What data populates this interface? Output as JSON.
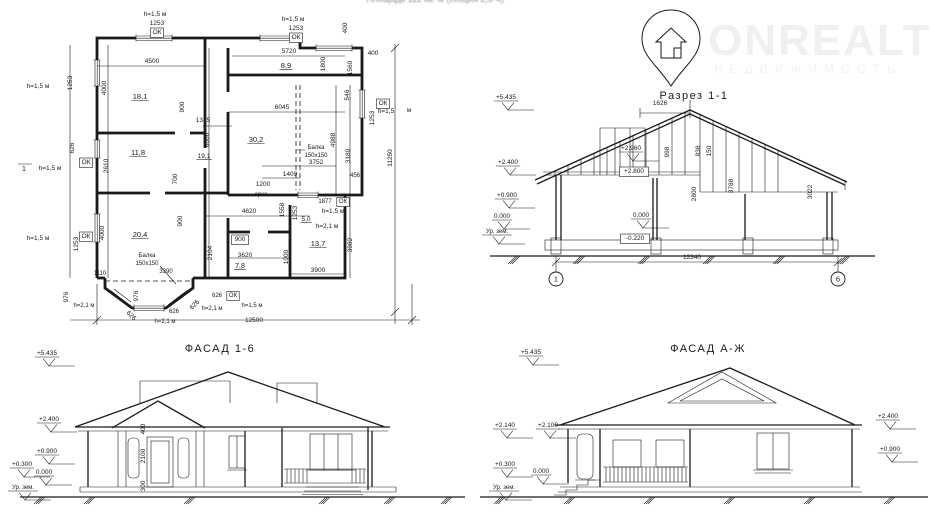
{
  "page": {
    "top_caption": "Площадь 111 кв. м (секция 2,3-4)"
  },
  "watermark": {
    "brand": "ONREALT",
    "subtitle": "НЕДВИЖИМОСТЬ",
    "icon": "location-pin-house-icon",
    "color": "#f1f1f1"
  },
  "drawings": {
    "floor_plan": {
      "name": "floor-plan",
      "labels": [
        {
          "t": "h=1,5 м",
          "x": 155,
          "y": 16
        },
        {
          "t": "1253",
          "x": 157,
          "y": 25
        },
        {
          "t": "ОК",
          "x": 157,
          "y": 34,
          "b": 1
        },
        {
          "t": "h=1,5 м",
          "x": 293,
          "y": 21
        },
        {
          "t": "1253",
          "x": 296,
          "y": 30
        },
        {
          "t": "ОК",
          "x": 296,
          "y": 39,
          "b": 1
        },
        {
          "t": "400",
          "x": 347,
          "y": 28,
          "r": -90
        },
        {
          "t": "4500",
          "x": 152,
          "y": 63
        },
        {
          "t": "4000",
          "x": 106,
          "y": 88,
          "r": -90
        },
        {
          "t": "18,1",
          "x": 140,
          "y": 99,
          "u": 1,
          "s": 7.5
        },
        {
          "t": "900",
          "x": 184,
          "y": 107,
          "r": -90
        },
        {
          "t": "1315",
          "x": 203,
          "y": 122
        },
        {
          "t": "8666",
          "x": 209,
          "y": 140,
          "r": -90
        },
        {
          "t": "19,1",
          "x": 204,
          "y": 158,
          "u": 1
        },
        {
          "t": "11,8",
          "x": 138,
          "y": 155,
          "u": 1,
          "s": 7.5
        },
        {
          "t": "2610",
          "x": 108,
          "y": 166,
          "r": -90
        },
        {
          "t": "1253",
          "x": 72,
          "y": 83,
          "r": -90
        },
        {
          "t": "h=1,5 м",
          "x": 38,
          "y": 88
        },
        {
          "t": "626",
          "x": 74,
          "y": 148,
          "r": -90
        },
        {
          "t": "ОК",
          "x": 86,
          "y": 164,
          "b": 1
        },
        {
          "t": "1",
          "x": 24,
          "y": 171,
          "s": 7
        },
        {
          "t": "h=1,5 м",
          "x": 50,
          "y": 170
        },
        {
          "t": "1253",
          "x": 78,
          "y": 244,
          "r": -90
        },
        {
          "t": "ОК",
          "x": 86,
          "y": 238,
          "b": 1
        },
        {
          "t": "h=1,5 м",
          "x": 38,
          "y": 240
        },
        {
          "t": "5720",
          "x": 289,
          "y": 53
        },
        {
          "t": "8,9",
          "x": 286,
          "y": 68,
          "u": 1,
          "s": 7.5
        },
        {
          "t": "1800",
          "x": 325,
          "y": 64,
          "r": -90
        },
        {
          "t": "1560",
          "x": 352,
          "y": 68,
          "r": -90
        },
        {
          "t": "400",
          "x": 373,
          "y": 55
        },
        {
          "t": "546",
          "x": 349,
          "y": 95,
          "r": -90
        },
        {
          "t": "ОК",
          "x": 383,
          "y": 105,
          "b": 1
        },
        {
          "t": "h=1,5",
          "x": 386,
          "y": 113
        },
        {
          "t": "м",
          "x": 409,
          "y": 112
        },
        {
          "t": "1253",
          "x": 374,
          "y": 118,
          "r": -90
        },
        {
          "t": "11250",
          "x": 392,
          "y": 158,
          "r": -90
        },
        {
          "t": "6045",
          "x": 282,
          "y": 109
        },
        {
          "t": "30,2",
          "x": 256,
          "y": 142,
          "u": 1,
          "s": 7.5
        },
        {
          "t": "Балка",
          "x": 316,
          "y": 149,
          "s": 6
        },
        {
          "t": "150х150",
          "x": 316,
          "y": 157,
          "s": 6
        },
        {
          "t": "4988",
          "x": 335,
          "y": 140,
          "r": -90
        },
        {
          "t": "3189",
          "x": 350,
          "y": 156,
          "r": -90
        },
        {
          "t": "3752",
          "x": 316,
          "y": 164
        },
        {
          "t": "456",
          "x": 355,
          "y": 177,
          "s": 6
        },
        {
          "t": "1409",
          "x": 290,
          "y": 176
        },
        {
          "t": "1200",
          "x": 263,
          "y": 186
        },
        {
          "t": "арка",
          "x": 261,
          "y": 196,
          "s": 6
        },
        {
          "t": "1877",
          "x": 325,
          "y": 203,
          "s": 6
        },
        {
          "t": "ОК",
          "x": 343,
          "y": 203,
          "b": 1,
          "s": 6
        },
        {
          "t": "h=1,5 м",
          "x": 333,
          "y": 213
        },
        {
          "t": "5,0",
          "x": 306,
          "y": 221,
          "u": 1,
          "s": 6.5
        },
        {
          "t": "h=2,1 м",
          "x": 327,
          "y": 228
        },
        {
          "t": "13,7",
          "x": 318,
          "y": 246,
          "u": 1,
          "s": 7.5
        },
        {
          "t": "1558",
          "x": 284,
          "y": 210,
          "r": -90
        },
        {
          "t": "1253",
          "x": 297,
          "y": 213,
          "r": -90
        },
        {
          "t": "1000",
          "x": 288,
          "y": 257,
          "r": -90
        },
        {
          "t": "3982",
          "x": 352,
          "y": 245,
          "r": -90
        },
        {
          "t": "3900",
          "x": 318,
          "y": 272
        },
        {
          "t": "4620",
          "x": 249,
          "y": 213
        },
        {
          "t": "900",
          "x": 240,
          "y": 241,
          "b": 1
        },
        {
          "t": "900",
          "x": 182,
          "y": 221,
          "r": -90
        },
        {
          "t": "700",
          "x": 177,
          "y": 179,
          "r": -90
        },
        {
          "t": "2104",
          "x": 212,
          "y": 253,
          "r": -90
        },
        {
          "t": "3620",
          "x": 245,
          "y": 257
        },
        {
          "t": "7,8",
          "x": 240,
          "y": 268,
          "u": 1,
          "s": 7
        },
        {
          "t": "20,4",
          "x": 140,
          "y": 237,
          "u": 1,
          "s": 7.5
        },
        {
          "t": "4000",
          "x": 104,
          "y": 233,
          "r": -90
        },
        {
          "t": "1110",
          "x": 100,
          "y": 275,
          "s": 6
        },
        {
          "t": "Балка",
          "x": 147,
          "y": 257,
          "s": 6
        },
        {
          "t": "150х150",
          "x": 147,
          "y": 265,
          "s": 6
        },
        {
          "t": "3390",
          "x": 166,
          "y": 273,
          "s": 6
        },
        {
          "t": "976",
          "x": 68,
          "y": 297,
          "r": -90
        },
        {
          "t": "h=2,1 м",
          "x": 84,
          "y": 307,
          "s": 6
        },
        {
          "t": "976",
          "x": 138,
          "y": 296,
          "r": -90
        },
        {
          "t": "626",
          "x": 130,
          "y": 317,
          "r": 45
        },
        {
          "t": "626",
          "x": 196,
          "y": 306,
          "r": -45
        },
        {
          "t": "626",
          "x": 174,
          "y": 313,
          "s": 6
        },
        {
          "t": "h=2,1 м",
          "x": 165,
          "y": 323,
          "s": 6
        },
        {
          "t": "626",
          "x": 217,
          "y": 297,
          "s": 6
        },
        {
          "t": "ОК",
          "x": 233,
          "y": 297,
          "b": 1,
          "s": 6
        },
        {
          "t": "h=2,1 м",
          "x": 212,
          "y": 310,
          "s": 6
        },
        {
          "t": "h=1,5 м",
          "x": 252,
          "y": 307,
          "s": 6
        },
        {
          "t": "12500",
          "x": 254,
          "y": 322
        }
      ]
    },
    "section": {
      "name": "section-1-1",
      "labels": [
        {
          "t": "Разрез 1-1",
          "x": 694,
          "y": 99,
          "k": "title",
          "s": 11
        },
        {
          "t": "+5.435",
          "x": 506,
          "y": 99,
          "f": 1
        },
        {
          "t": "+2.400",
          "x": 508,
          "y": 164,
          "f": 1
        },
        {
          "t": "+0.900",
          "x": 507,
          "y": 197,
          "f": 1
        },
        {
          "t": "0.000",
          "x": 502,
          "y": 218,
          "f": 1
        },
        {
          "t": "Ур. зем.",
          "x": 497,
          "y": 233,
          "s": 6,
          "f": 1
        },
        {
          "t": "1626",
          "x": 660,
          "y": 105
        },
        {
          "t": "+2.960",
          "x": 631,
          "y": 150,
          "f": 1
        },
        {
          "t": "+2.800",
          "x": 634,
          "y": 173,
          "b": 1
        },
        {
          "t": "998",
          "x": 669,
          "y": 152,
          "r": -90
        },
        {
          "t": "838",
          "x": 700,
          "y": 151,
          "r": -90
        },
        {
          "t": "150",
          "x": 711,
          "y": 151,
          "r": -90
        },
        {
          "t": "2800",
          "x": 696,
          "y": 194,
          "r": -90
        },
        {
          "t": "3788",
          "x": 733,
          "y": 186,
          "r": -90
        },
        {
          "t": "3022",
          "x": 812,
          "y": 192,
          "r": -90
        },
        {
          "t": "0.000",
          "x": 641,
          "y": 217,
          "f": 1
        },
        {
          "t": "-0.220",
          "x": 635,
          "y": 240,
          "b": 1
        },
        {
          "t": "12340",
          "x": 692,
          "y": 259
        }
      ],
      "markers": [
        {
          "t": "1",
          "x": 556,
          "y": 279
        },
        {
          "t": "6",
          "x": 838,
          "y": 279
        }
      ]
    },
    "facade_16": {
      "name": "facade-1-6",
      "labels": [
        {
          "t": "ФАСАД 1-6",
          "x": 220,
          "y": 352,
          "k": "title",
          "s": 11
        },
        {
          "t": "+5.435",
          "x": 47,
          "y": 355,
          "f": 1
        },
        {
          "t": "+2.400",
          "x": 49,
          "y": 421,
          "f": 1
        },
        {
          "t": "+0.900",
          "x": 47,
          "y": 453,
          "f": 1
        },
        {
          "t": "+0.300",
          "x": 22,
          "y": 466,
          "f": 1
        },
        {
          "t": "0.000",
          "x": 44,
          "y": 474,
          "f": 1
        },
        {
          "t": "Ур. зем.",
          "x": 23,
          "y": 489,
          "s": 6,
          "f": 1
        },
        {
          "t": "400",
          "x": 145,
          "y": 429,
          "r": -90
        },
        {
          "t": "2100",
          "x": 145,
          "y": 456,
          "r": -90
        },
        {
          "t": "300",
          "x": 145,
          "y": 486,
          "r": -90
        }
      ]
    },
    "facade_azh": {
      "name": "facade-a-zh",
      "labels": [
        {
          "t": "ФАСАД А-Ж",
          "x": 708,
          "y": 352,
          "k": "title",
          "s": 11
        },
        {
          "t": "+5.435",
          "x": 531,
          "y": 354,
          "f": 1
        },
        {
          "t": "+2.140",
          "x": 505,
          "y": 427,
          "f": 1
        },
        {
          "t": "+2.100",
          "x": 548,
          "y": 427,
          "f": 1
        },
        {
          "t": "+0.300",
          "x": 505,
          "y": 466,
          "f": 1
        },
        {
          "t": "0.000",
          "x": 541,
          "y": 473,
          "f": 1
        },
        {
          "t": "Ур. зем.",
          "x": 504,
          "y": 489,
          "s": 6,
          "f": 1
        },
        {
          "t": "+2.400",
          "x": 888,
          "y": 418,
          "f": 1
        },
        {
          "t": "+0.900",
          "x": 890,
          "y": 451,
          "f": 1
        }
      ]
    }
  }
}
